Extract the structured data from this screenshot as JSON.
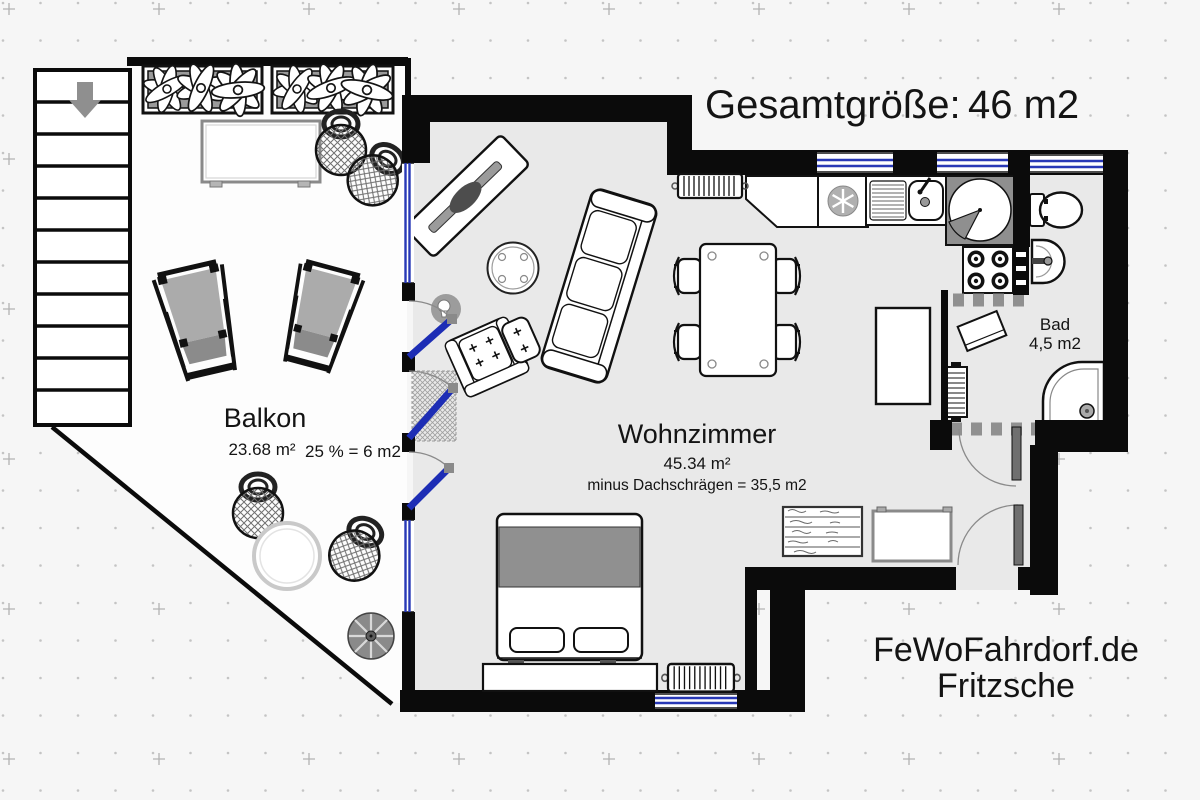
{
  "header": {
    "label": "Gesamtgröße:",
    "value": "46 m2"
  },
  "rooms": {
    "balkon": {
      "name": "Balkon",
      "area": "23.68 m²",
      "note": "25 % = 6 m2"
    },
    "wohnzimmer": {
      "name": "Wohnzimmer",
      "area": "45.34 m²",
      "note": "minus Dachschrägen = 35,5 m2"
    },
    "bad": {
      "name": "Bad",
      "area": "4,5 m2"
    }
  },
  "footer": {
    "website": "FeWoFahrdorf.de",
    "owner": "Fritzsche"
  },
  "colors": {
    "background": "#f6f6f6",
    "wall": "#0b0b0b",
    "floor": "#e9e9e9",
    "balcony_floor": "#fdfdfd",
    "window_glass": "#2838b6",
    "door_leaf": "#1d2db5",
    "furniture_gray": "#9a9a9a"
  },
  "fixtures": [
    "stairs-down",
    "flower-planter",
    "balcony-table",
    "potted-plant",
    "deck-chair",
    "round-garden-table",
    "parasol-base",
    "tv-sideboard",
    "coffee-table",
    "sofa",
    "armchair",
    "ottoman",
    "floor-lamp",
    "doormat",
    "dining-table",
    "dining-chair",
    "radiator",
    "kitchen-counter",
    "fridge",
    "kitchen-sink",
    "corner-carousel",
    "stove",
    "toilet",
    "washbasin",
    "bath-shelf",
    "shower",
    "wardrobe",
    "dresser",
    "side-table",
    "double-bed",
    "bed-bench",
    "entry-door",
    "bath-door",
    "balcony-door"
  ]
}
